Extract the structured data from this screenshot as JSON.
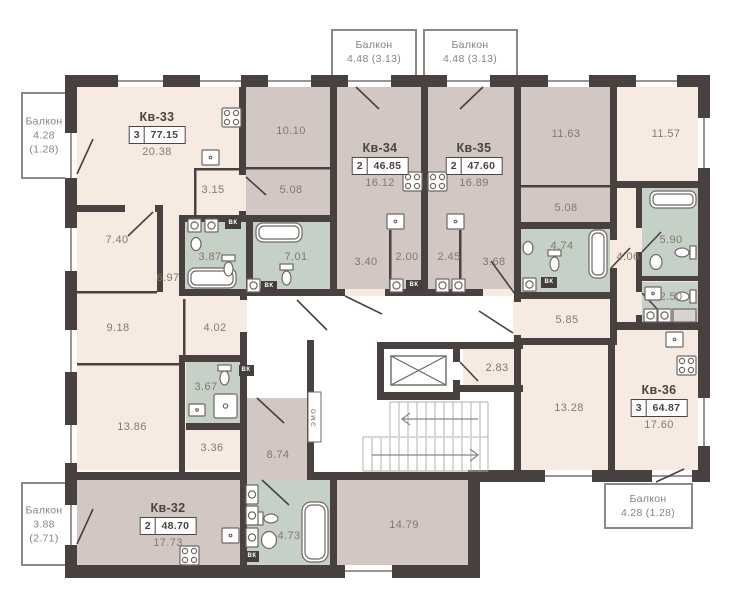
{
  "colors": {
    "wall": "#494140",
    "room_warm": "#f7ebe1",
    "room_mauve": "#d2c7c2",
    "room_wet": "#c5d0c7",
    "corridor": "#ffffff",
    "balcony_border": "#8d8884",
    "area_text": "#84796f",
    "dark_text": "#4d4441"
  },
  "apartments": [
    {
      "name": "Кв-33",
      "rooms": "3",
      "total_area": "77.15",
      "living_area": "20.38"
    },
    {
      "name": "Кв-34",
      "rooms": "2",
      "total_area": "46.85",
      "living_area": "16.12"
    },
    {
      "name": "Кв-35",
      "rooms": "2",
      "total_area": "47.60",
      "living_area": "16.89"
    },
    {
      "name": "Кв-36",
      "rooms": "3",
      "total_area": "64.87",
      "living_area": "17.60"
    },
    {
      "name": "Кв-32",
      "rooms": "2",
      "total_area": "48.70",
      "living_area": "17.73"
    }
  ],
  "balconies": [
    {
      "title": "Балкон",
      "line1": "4.28",
      "line2": "(1.28)"
    },
    {
      "title": "Балкон",
      "line1": "4.48 (3.13)",
      "line2": ""
    },
    {
      "title": "Балкон",
      "line1": "4.48 (3.13)",
      "line2": ""
    },
    {
      "title": "Балкон",
      "line1": "4.28 (1.28)",
      "line2": ""
    },
    {
      "title": "Балкон",
      "line1": "3.88",
      "line2": "(2.71)"
    }
  ],
  "room_areas": [
    {
      "id": "room-10-10",
      "area": "10.10"
    },
    {
      "id": "room-3-15",
      "area": "3.15"
    },
    {
      "id": "room-5-08-left",
      "area": "5.08"
    },
    {
      "id": "room-7-40",
      "area": "7.40"
    },
    {
      "id": "room-3-87",
      "area": "3.87"
    },
    {
      "id": "room-7-01",
      "area": "7.01"
    },
    {
      "id": "room-6-97",
      "area": "6.97"
    },
    {
      "id": "room-3-40",
      "area": "3.40"
    },
    {
      "id": "room-2-00",
      "area": "2.00"
    },
    {
      "id": "room-2-45",
      "area": "2.45"
    },
    {
      "id": "room-3-68",
      "area": "3.68"
    },
    {
      "id": "room-11-63",
      "area": "11.63"
    },
    {
      "id": "room-11-57",
      "area": "11.57"
    },
    {
      "id": "room-5-08-right",
      "area": "5.08"
    },
    {
      "id": "room-4-74",
      "area": "4.74"
    },
    {
      "id": "room-4-06",
      "area": "4.06"
    },
    {
      "id": "room-5-90",
      "area": "5.90"
    },
    {
      "id": "room-2-50",
      "area": "2.50"
    },
    {
      "id": "room-5-85",
      "area": "5.85"
    },
    {
      "id": "room-2-83",
      "area": "2.83"
    },
    {
      "id": "room-13-28",
      "area": "13.28"
    },
    {
      "id": "room-9-18",
      "area": "9.18"
    },
    {
      "id": "room-4-02",
      "area": "4.02"
    },
    {
      "id": "room-3-67",
      "area": "3.67"
    },
    {
      "id": "room-13-86",
      "area": "13.86"
    },
    {
      "id": "room-3-36",
      "area": "3.36"
    },
    {
      "id": "room-8-74",
      "area": "8.74"
    },
    {
      "id": "room-4-73",
      "area": "4.73"
    },
    {
      "id": "room-14-79",
      "area": "14.79"
    }
  ],
  "shaft_labels": {
    "vk": "ВК",
    "emo": "ЭМО"
  }
}
